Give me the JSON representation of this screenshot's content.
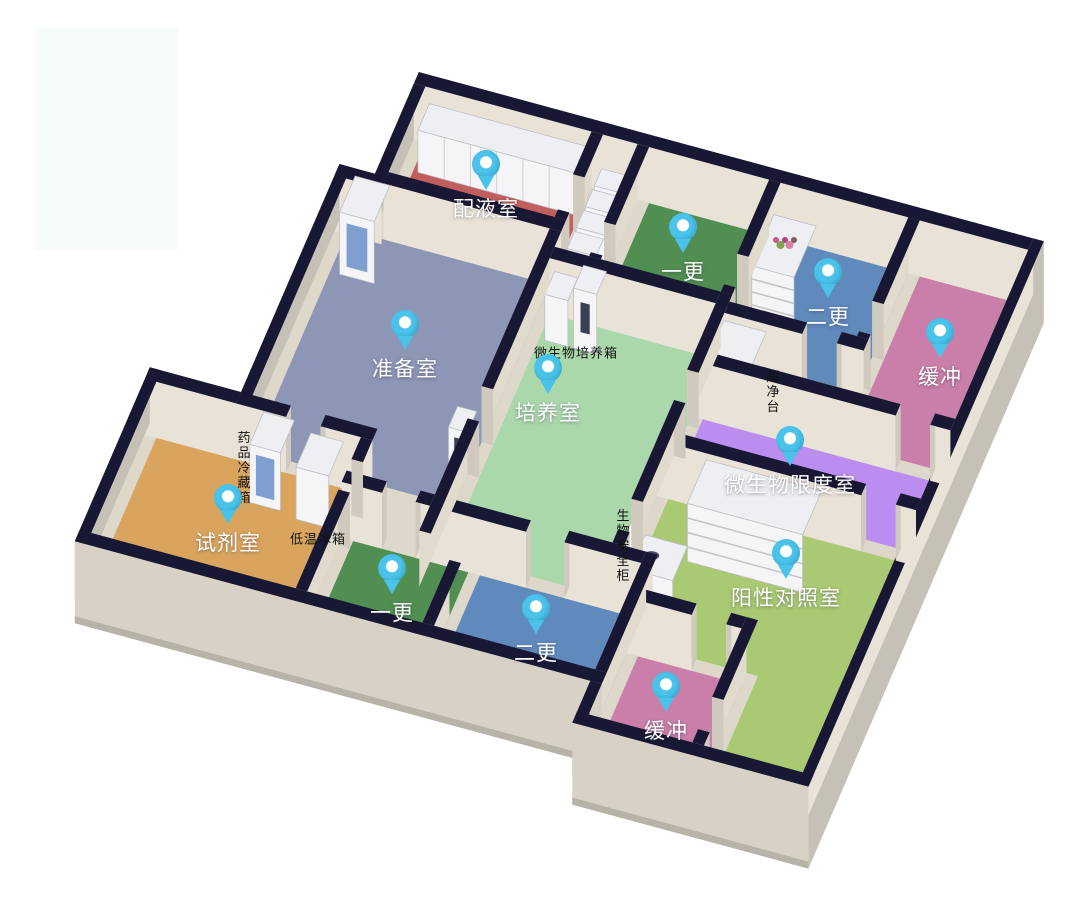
{
  "scene": {
    "width": 1068,
    "height": 918,
    "background": "#ffffff"
  },
  "watermark_patch": {
    "x": 36,
    "y": 28,
    "w": 142,
    "h": 222,
    "color": "#f7fbfc"
  },
  "palette": {
    "wall_top": "#181834",
    "wall_face": "#e9e3d7",
    "wall_face_side": "#e1dbce",
    "wall_outer": "#c6c1b7",
    "slab": "#ded8cb",
    "skirt": "#b8b3a9",
    "cap": "#d0cabe",
    "pin": "#4ac2e9",
    "box_front": "#f5f5f7",
    "box_side": "#d8dae0",
    "box_top": "#edeff2",
    "blue_door": "#7f9fd0",
    "south_face": "#d8d2c6"
  },
  "rooms": [
    {
      "id": "peiyeshi",
      "label": "配液室",
      "floor": "#c25e5e",
      "rect": [
        27,
        50,
        200,
        140
      ],
      "pin_px": [
        486,
        192
      ]
    },
    {
      "id": "yigeng-top",
      "label": "一更",
      "floor": "#518e52",
      "rect": [
        260,
        50,
        385,
        168
      ],
      "pin_px": [
        683,
        255
      ]
    },
    {
      "id": "ergeng-top",
      "label": "二更",
      "floor": "#6089bc",
      "rect": [
        397,
        50,
        530,
        175
      ],
      "pin_px": [
        828,
        300
      ]
    },
    {
      "id": "huanchong-top",
      "label": "缓冲",
      "floor": "#c97fa9",
      "rect": [
        542,
        50,
        655,
        228
      ],
      "pin_px": [
        940,
        360
      ]
    },
    {
      "id": "weishengwu-xiandushi",
      "label": "微生物限度室",
      "floor": "#bb8df0",
      "rect": [
        397,
        240,
        655,
        312
      ],
      "pin_px": [
        790,
        468
      ]
    },
    {
      "id": "peiyangshi",
      "label": "培养室",
      "floor": "#abd8ab",
      "rect": [
        212,
        180,
        385,
        432
      ],
      "pin_px": [
        548,
        396
      ]
    },
    {
      "id": "zhunbeishi",
      "label": "准备室",
      "floor": "#8e96b6",
      "rect": [
        -10,
        152,
        200,
        385
      ],
      "pin_px": [
        405,
        352
      ]
    },
    {
      "id": "shijishi",
      "label": "试剂室",
      "floor": "#d9a55e",
      "rect": [
        -105,
        397,
        108,
        556
      ],
      "pin_px": [
        228,
        526
      ]
    },
    {
      "id": "yigeng-bottom",
      "label": "一更",
      "floor": "#518e52",
      "rect": [
        120,
        444,
        240,
        556
      ],
      "pin_px": [
        392,
        596
      ]
    },
    {
      "id": "ergeng-bottom",
      "label": "二更",
      "floor": "#6089bc",
      "rect": [
        252,
        444,
        420,
        556
      ],
      "pin_px": [
        536,
        636
      ]
    },
    {
      "id": "yangxing-duizhaoshi",
      "label": "阳性对照室",
      "floor": "#a9c973",
      "poly": [
        [
          397,
          324
        ],
        [
          655,
          324
        ],
        [
          655,
          600
        ],
        [
          552,
          600
        ],
        [
          552,
          468
        ],
        [
          432,
          468
        ],
        [
          432,
          432
        ],
        [
          397,
          432
        ]
      ],
      "pin_px": [
        786,
        581
      ]
    },
    {
      "id": "huanchong-bottom",
      "label": "缓冲",
      "floor": "#c97fa9",
      "rect": [
        432,
        480,
        540,
        600
      ],
      "pin_px": [
        666,
        714
      ]
    }
  ],
  "equipment_labels": [
    {
      "id": "weishengwu-peiyangxiang",
      "text": "微生物培养箱",
      "vertical": false,
      "px": [
        576,
        352
      ]
    },
    {
      "id": "chaojingtai",
      "text": "超净台",
      "vertical": true,
      "px": [
        772,
        392
      ]
    },
    {
      "id": "yaopin-lengcangxiang",
      "text": "药品冷藏箱",
      "vertical": true,
      "px": [
        243,
        468
      ]
    },
    {
      "id": "diwen-bingxiang",
      "text": "低温冰箱",
      "vertical": false,
      "px": [
        318,
        538
      ]
    },
    {
      "id": "shengwu-anquangui",
      "text": "生物安全柜",
      "vertical": true,
      "px": [
        622,
        546
      ]
    }
  ],
  "geometry": {
    "projection": {
      "origin": [
        420,
        88
      ],
      "ex": [
        0.96,
        0.26
      ],
      "sv": [
        -0.41,
        0.95
      ],
      "wall_h": 56,
      "skirt": 26
    },
    "slab_outline": [
      [
        15,
        38
      ],
      [
        666,
        38
      ],
      [
        666,
        612
      ],
      [
        425,
        612
      ],
      [
        425,
        568
      ],
      [
        -117,
        568
      ],
      [
        -117,
        385
      ],
      [
        -22,
        385
      ],
      [
        -22,
        145
      ],
      [
        15,
        145
      ]
    ],
    "walls_pre": [
      {
        "t": "h",
        "x1": 15,
        "x2": 666,
        "y1": 38,
        "y2": 50,
        "k": "int"
      },
      {
        "t": "v",
        "x1": 655,
        "x2": 666,
        "y1": 38,
        "y2": 612,
        "k": "east"
      },
      {
        "t": "v",
        "x1": 15,
        "x2": 27,
        "y1": 50,
        "y2": 152,
        "k": "wgray"
      },
      {
        "t": "h",
        "x1": -22,
        "x2": 27,
        "y1": 145,
        "y2": 157,
        "k": "int"
      },
      {
        "t": "v",
        "x1": -22,
        "x2": -10,
        "y1": 145,
        "y2": 397,
        "k": "wgray"
      },
      {
        "t": "h",
        "x1": -117,
        "x2": -22,
        "y1": 385,
        "y2": 397,
        "k": "int"
      },
      {
        "t": "v",
        "x1": -117,
        "x2": -105,
        "y1": 385,
        "y2": 568,
        "k": "wgray"
      }
    ],
    "mid": [
      {
        "e": "box",
        "n": "cabinet-row",
        "r": [
          32,
          52,
          196,
          80
        ],
        "h": 42,
        "s": "counter"
      },
      {
        "e": "box",
        "n": "shelf-flowers",
        "r": [
          402,
          78,
          446,
          132
        ],
        "h": 52,
        "s": "shelf",
        "flowers": true
      },
      {
        "e": "wallv",
        "x1": 200,
        "x2": 212,
        "y1": 50,
        "y2": 140,
        "gaps": [
          [
            95,
            132
          ]
        ]
      },
      {
        "e": "wallh",
        "x1": 27,
        "x2": 212,
        "y1": 140,
        "y2": 152,
        "gaps": []
      },
      {
        "e": "box",
        "n": "locker",
        "r": [
          214,
          58,
          244,
          76
        ],
        "h": 30,
        "s": "plain"
      },
      {
        "e": "box",
        "n": "locker",
        "r": [
          214,
          80,
          244,
          98
        ],
        "h": 30,
        "s": "plain"
      },
      {
        "e": "box",
        "n": "locker",
        "r": [
          214,
          102,
          244,
          120
        ],
        "h": 30,
        "s": "plain"
      },
      {
        "e": "box",
        "n": "locker",
        "r": [
          214,
          124,
          244,
          142
        ],
        "h": 30,
        "s": "plain"
      },
      {
        "e": "box",
        "n": "locker",
        "r": [
          214,
          146,
          244,
          164
        ],
        "h": 30,
        "s": "plain"
      },
      {
        "e": "wallv",
        "x1": 248,
        "x2": 260,
        "y1": 50,
        "y2": 168,
        "gaps": [
          [
            132,
            164
          ]
        ]
      },
      {
        "e": "wallv",
        "x1": 385,
        "x2": 397,
        "y1": 50,
        "y2": 168,
        "gaps": [
          [
            128,
            160
          ]
        ]
      },
      {
        "e": "wallv",
        "x1": 530,
        "x2": 542,
        "y1": 50,
        "y2": 175,
        "gaps": [
          [
            138,
            170
          ]
        ]
      },
      {
        "e": "wallh",
        "x1": 212,
        "x2": 397,
        "y1": 168,
        "y2": 180,
        "gaps": []
      },
      {
        "e": "wallh",
        "x1": 397,
        "x2": 542,
        "y1": 175,
        "y2": 187,
        "gaps": [
          [
            478,
            514
          ]
        ]
      },
      {
        "e": "box",
        "n": "air-shower",
        "r": [
          0,
          158,
          36,
          196
        ],
        "h": 62,
        "s": "bluedoor"
      },
      {
        "e": "box",
        "n": "incubator-a",
        "r": [
          218,
          182,
          242,
          206
        ],
        "h": 46,
        "s": "plain"
      },
      {
        "e": "box",
        "n": "incubator-b",
        "r": [
          248,
          182,
          272,
          206
        ],
        "h": 60,
        "s": "slot"
      },
      {
        "e": "box",
        "n": "clean-bench",
        "r": [
          402,
          200,
          446,
          238
        ],
        "h": 62,
        "s": "bench"
      },
      {
        "e": "wallh",
        "x1": 385,
        "x2": 655,
        "y1": 228,
        "y2": 240,
        "gaps": [
          [
            598,
            634
          ]
        ]
      },
      {
        "e": "box",
        "n": "side-table",
        "r": [
          470,
          288,
          575,
          303
        ],
        "h": 14,
        "s": "plain"
      },
      {
        "e": "wallh",
        "x1": 385,
        "x2": 655,
        "y1": 312,
        "y2": 324,
        "gaps": [
          [
            598,
            634
          ]
        ]
      },
      {
        "e": "box",
        "n": "tier-shelf",
        "r": [
          440,
          332,
          560,
          378
        ],
        "h": 58,
        "s": "shelf"
      },
      {
        "e": "box",
        "n": "pass-box",
        "r": [
          180,
          330,
          200,
          352
        ],
        "h": 42,
        "s": "slot"
      },
      {
        "e": "wallh",
        "x1": -22,
        "x2": 120,
        "y1": 385,
        "y2": 397,
        "gaps": [
          [
            30,
            66
          ]
        ]
      },
      {
        "e": "box",
        "n": "biosafety-cabinet",
        "r": [
          402,
          392,
          446,
          428
        ],
        "h": 30,
        "s": "sink"
      },
      {
        "e": "door",
        "x": 391,
        "ya": 388,
        "yb": 418,
        "h": 48
      },
      {
        "e": "wallv",
        "x1": 385,
        "x2": 397,
        "y1": 168,
        "y2": 432,
        "gaps": [
          [
            250,
            282
          ],
          [
            386,
            418
          ]
        ]
      },
      {
        "e": "box",
        "n": "medicine-fridge",
        "r": [
          8,
          400,
          40,
          434
        ],
        "h": 58,
        "s": "bluedoor"
      },
      {
        "e": "box",
        "n": "freezer",
        "r": [
          58,
          402,
          92,
          438
        ],
        "h": 52,
        "s": "plain"
      },
      {
        "e": "wallh",
        "x1": 108,
        "x2": 432,
        "y1": 432,
        "y2": 444,
        "gaps": [
          [
            150,
            185
          ],
          [
            300,
            340
          ]
        ]
      },
      {
        "e": "wallv",
        "x1": 200,
        "x2": 212,
        "y1": 152,
        "y2": 470,
        "gaps": [
          [
            318,
            352
          ]
        ]
      },
      {
        "e": "wallh",
        "x1": 420,
        "x2": 540,
        "y1": 468,
        "y2": 480,
        "gaps": [
          [
            488,
            524
          ]
        ]
      },
      {
        "e": "wallv",
        "x1": 108,
        "x2": 120,
        "y1": 397,
        "y2": 556,
        "gaps": [
          [
            420,
            452
          ]
        ]
      },
      {
        "e": "wallv",
        "x1": 240,
        "x2": 252,
        "y1": 490,
        "y2": 556,
        "gaps": []
      },
      {
        "e": "wallv",
        "x1": 420,
        "x2": 432,
        "y1": 432,
        "y2": 556,
        "gaps": []
      },
      {
        "e": "wallv",
        "x1": 540,
        "x2": 552,
        "y1": 468,
        "y2": 600,
        "gaps": [
          [
            552,
            586
          ]
        ]
      }
    ],
    "walls_post": [
      {
        "t": "h",
        "x1": -117,
        "x2": 432,
        "y1": 556,
        "y2": 568,
        "k": "south"
      },
      {
        "t": "v",
        "x1": 420,
        "x2": 432,
        "y1": 568,
        "y2": 612,
        "k": "wgray"
      },
      {
        "t": "h",
        "x1": 420,
        "x2": 666,
        "y1": 600,
        "y2": 612,
        "k": "south"
      }
    ],
    "flower_colors": [
      "#c9578a",
      "#7fa34f",
      "#b1447a",
      "#d87fa5",
      "#8a5568"
    ]
  }
}
